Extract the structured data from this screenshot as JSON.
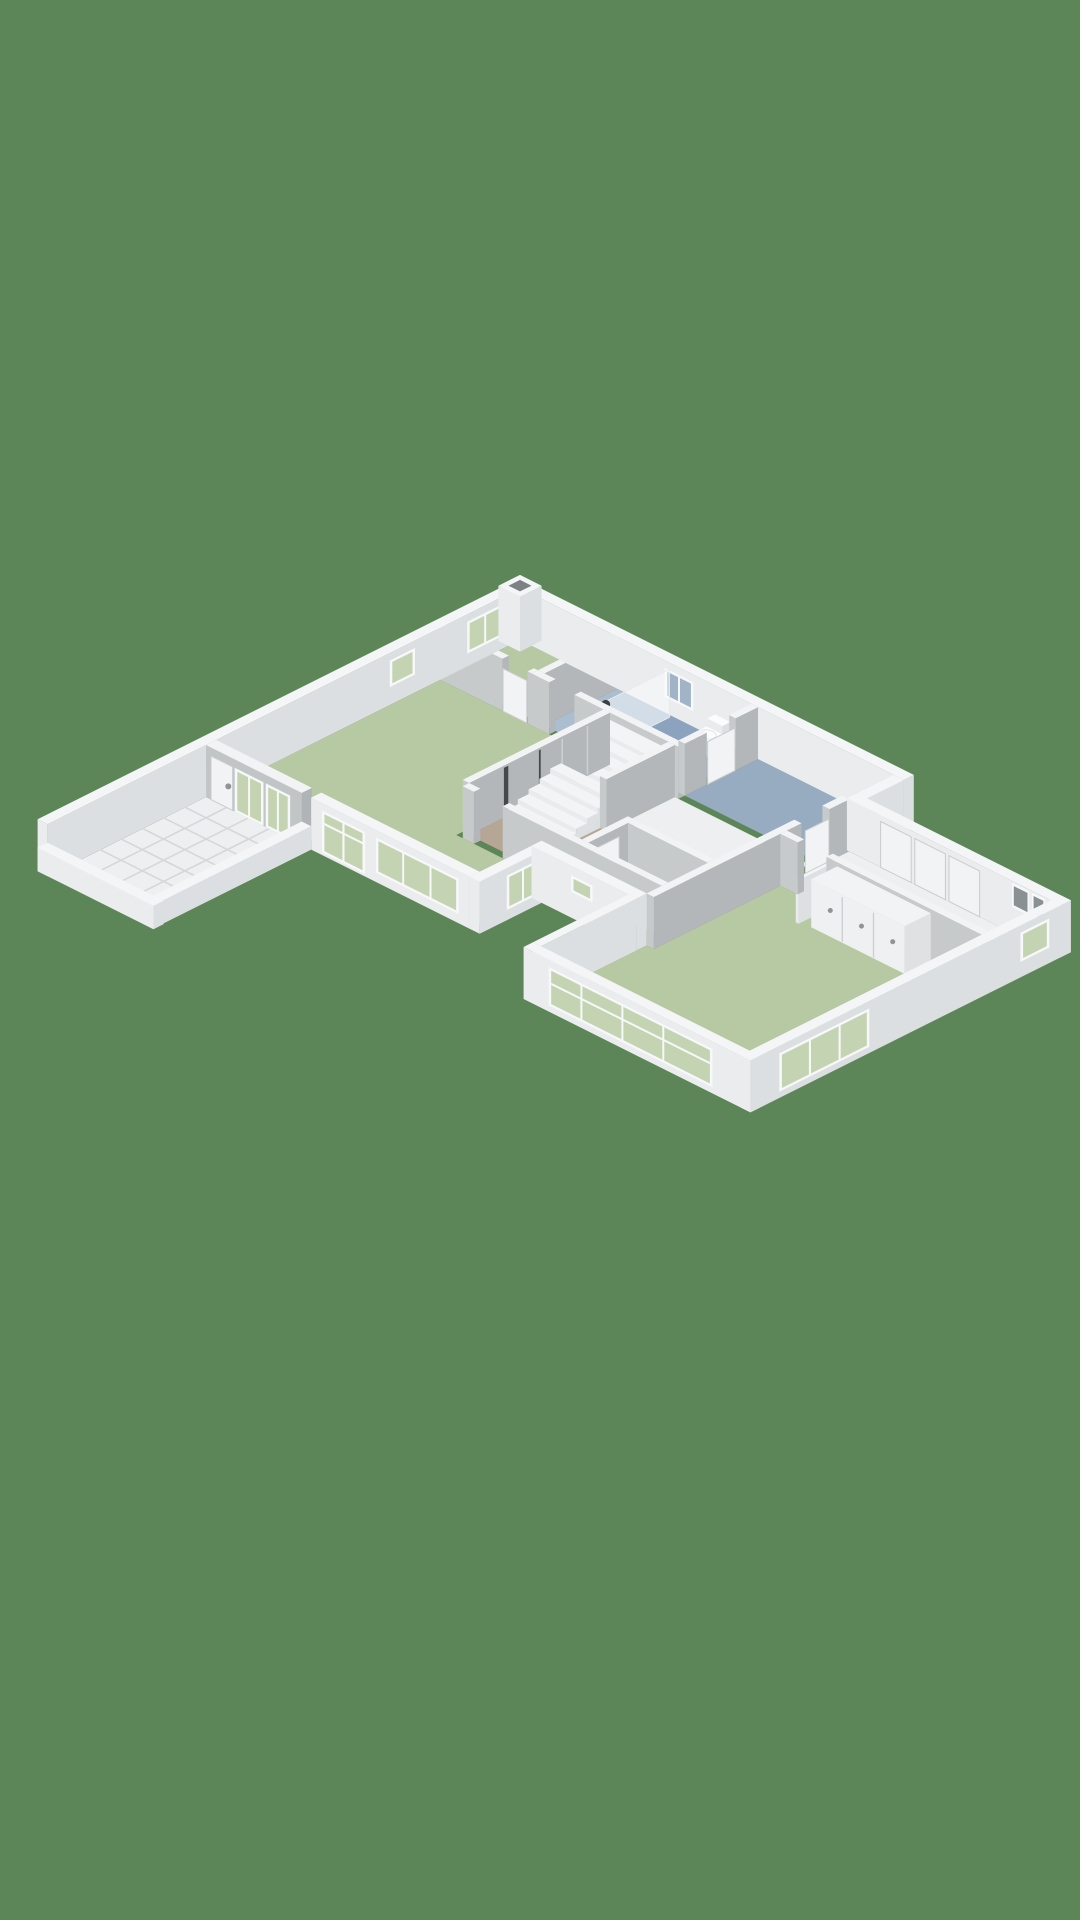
{
  "scene": {
    "type": "isometric-3d-floorplan-render",
    "background": "#5c8657",
    "canvas": {
      "width": 1080,
      "height": 1920
    }
  },
  "palette": {
    "wall_exterior": {
      "top": "#f4f5f6",
      "side_sw": "#eaeced",
      "side_se": "#dcdfe1"
    },
    "wall_interior": {
      "top": "#f2f3f4",
      "side_sw": "#c7cacb",
      "side_se": "#b3b7b9"
    },
    "wall_shaded": {
      "top": "#f2f3f4",
      "side_sw": "#c2c5c6",
      "side_se": "#b0b4b6"
    },
    "stairs": {
      "top": "#f3f4f5",
      "side_sw": "#e9ebec",
      "side_se": "#dde0e2"
    },
    "closet": {
      "top": "#f2f3f4",
      "side_sw": "#eef0f1",
      "side_se": "#dfe1e3",
      "seam": "#cdd0d2",
      "handle": "#8f9496"
    },
    "window_frame": "#f7f8f9",
    "glass_green": "#c4d3b1",
    "glass_blue": "#a0b3c7",
    "door_panel": "#f1f3f4",
    "door_edge": "#c9cccd",
    "dark_slit": "#45494c",
    "vent_recess": "#8b9193",
    "shower_glass": "rgba(250,252,253,0.5)",
    "shower_knob": "#3c4043",
    "fixture_white": "#fbfcfd",
    "chimney_hole": "#7c8284"
  },
  "rooms": [
    {
      "id": "bedroom-north",
      "floor": "#b7c9a3"
    },
    {
      "id": "bathroom",
      "floor": "#8ba3be",
      "shower_floor": "#abbed0"
    },
    {
      "id": "bathroom-2",
      "floor": "#97abc1"
    },
    {
      "id": "lobby",
      "floor": "#edeff0"
    },
    {
      "id": "hallway",
      "floor": "#b5a695"
    },
    {
      "id": "toilet",
      "floor": "#c9cdc7"
    },
    {
      "id": "living-kitchen",
      "floor": "#b7c9a3"
    },
    {
      "id": "bedroom-east",
      "floor": "#b7c9a3"
    },
    {
      "id": "corridor-east",
      "floor": "#edeff0"
    },
    {
      "id": "terrace",
      "floor": "#edeff0",
      "tile_grid": "#d5d8da"
    }
  ],
  "features": [
    "staircase",
    "shower-glass-panel",
    "toilet-fixture",
    "french-doors-to-terrace",
    "wardrobe-sliding-doors",
    "closet-row",
    "chimney-shaft",
    "windows-green-glass",
    "windows-blue-glass",
    "terrace-tiles"
  ]
}
